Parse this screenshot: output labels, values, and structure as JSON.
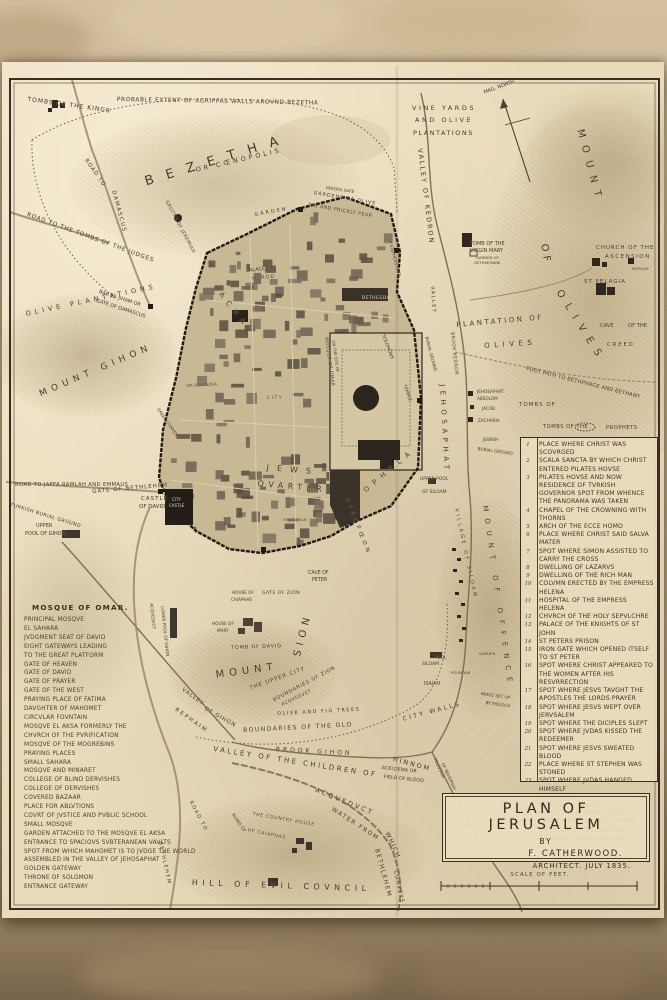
{
  "colors": {
    "paper": "#e8daba",
    "ink": "#3d3428",
    "wall_dark": "#201b15",
    "hill": "#a8946d",
    "backdrop": "#c9b492"
  },
  "sheet": {
    "title_block": {
      "line1": "PLAN OF JERUSALEM",
      "line2": "BY",
      "line3": "F. CATHERWOOD.",
      "line4": "ARCHITECT. JULY 1835."
    },
    "scale": {
      "label": "SCALE OF FEET."
    },
    "mosque_list": {
      "title": "MOSQUE OF OMAR.",
      "lines": [
        "PRINCIPAL MOSQVE",
        "EL SAHARA",
        "JVDGMENT SEAT OF DAVID",
        "EIGHT GATEWAYS LEADING",
        "TO THE GREAT PLATFORM",
        "GATE OF HEAVEN",
        "GATE OF DAVID",
        "GATE OF PRAYER",
        "GATE OF THE WEST",
        "PRAYING PLACE OF FATIMA",
        "DAVGHTER OF MAHOMET",
        "CIRCVLAR FOVNTAIN",
        "MOSQVE EL AKSA FORMERLY THE",
        "CHVRCH OF THE PVRIFICATION",
        "MOSQVE OF THE MOGREBINS",
        "PRAYING PLACES",
        "SMALL SAHARA",
        "MOSQVE AND MINARET",
        "COLLEGE OF BLIND DERVISHES",
        "COLLEGE OF DERVISHES",
        "COVERED BAZAAR",
        "PLACE FOR ABLVTIONS",
        "COVRT OF JVSTICE AND PVBLIC SCHOOL",
        "SMALL MOSQVE",
        "GARDEN ATTACHED TO THE MOSQVE EL AKSA",
        "ENTRANCE TO SPACIOVS SVBTERANEAN VAVLTS",
        "SPOT FROM WHICH MAHOMET IS TO JVDGE THE WORLD",
        "ASSEMBLED IN THE VALLEY OF JEHOSAPHAT",
        "GOLDEN GATEWAY",
        "THRONE OF SOLOMON",
        "ENTRANCE GATEWAY"
      ]
    },
    "reference_list": {
      "items": [
        {
          "n": "1",
          "t": "PLACE WHERE CHRIST WAS SCOVRGED"
        },
        {
          "n": "2",
          "t": "SCALA SANCTA BY WHICH CHRIST ENTERED PILATES HOVSE"
        },
        {
          "n": "3",
          "t": "PILATES HOVSE AND NOW RESIDENCE OF TVRKISH GOVERNOR  SPOT FROM WHENCE THE PANORAMA WAS TAKEN"
        },
        {
          "n": "4",
          "t": "CHAPEL OF THE CROWNING WITH THORNS"
        },
        {
          "n": "5",
          "t": "ARCH OF THE ECCE HOMO"
        },
        {
          "n": "6",
          "t": "PLACE WHERE CHRIST SAID SALVA MATER"
        },
        {
          "n": "7",
          "t": "SPOT WHERE SIMON ASSISTED TO CARRY THE CROSS"
        },
        {
          "n": "8",
          "t": "DWELLING OF LAZARVS"
        },
        {
          "n": "9",
          "t": "DWELLING OF THE RICH MAN"
        },
        {
          "n": "10",
          "t": "COLVMN ERECTED BY THE EMPRESS HELENA"
        },
        {
          "n": "11",
          "t": "HOSPITAL OF THE EMPRESS HELENA"
        },
        {
          "n": "12",
          "t": "CHVRCH OF THE HOLY SEPVLCHRE"
        },
        {
          "n": "13",
          "t": "PALACE OF THE KNIGHTS OF ST JOHN"
        },
        {
          "n": "14",
          "t": "ST PETERS PRISON"
        },
        {
          "n": "15",
          "t": "IRON GATE WHICH OPENED ITSELF TO ST PETER"
        },
        {
          "n": "16",
          "t": "SPOT WHERE CHRIST APPEARED TO THE WOMEN AFTER HIS RESVRRECTION"
        },
        {
          "n": "17",
          "t": "SPOT WHERE JESVS TAVGHT THE APOSTLES THE LORDS PRAYER"
        },
        {
          "n": "18",
          "t": "SPOT WHERE JESVS WEPT OVER JERVSALEM"
        },
        {
          "n": "19",
          "t": "SPOT WHERE THE DICIPLES SLEPT"
        },
        {
          "n": "20",
          "t": "SPOT WHERE JVDAS KISSED THE REDEEMER"
        },
        {
          "n": "21",
          "t": "SPOT WHERE JESVS SWEATED BLOOD"
        },
        {
          "n": "22",
          "t": "PLACE WHERE ST STEPHEN WAS STONED"
        },
        {
          "n": "23",
          "t": "SPOT WHERE JVDAS HANGED HIMSELF"
        },
        {
          "n": "24",
          "t": "SPOT WHERE THE PROPHET ISAIAH WAS SAWN ASVNDER"
        },
        {
          "n": "25",
          "t": "CŒNACVLVM WHERE CHRIST INSTITVTED THE LAST SVPPER"
        },
        {
          "n": "26",
          "t": "CATHOLIC BVRIAL GROVND"
        },
        {
          "n": "27",
          "t": "ARMENIAN BVRIAL GROVND"
        }
      ]
    },
    "labels": [
      {
        "t": "TOMBS OF THE KINGS",
        "x": 28,
        "y": 96,
        "r": 8,
        "s": 6,
        "p": 1
      },
      {
        "t": "PROBABLE EXTENT OF AGRIPPAS WALLS AROVND BEZETHA",
        "x": 117,
        "y": 97,
        "r": 1,
        "s": 5.8,
        "p": 0.6
      },
      {
        "t": "VINE YARDS",
        "x": 412,
        "y": 104,
        "s": 6.5,
        "p": 2.5
      },
      {
        "t": "AND OLIVE",
        "x": 415,
        "y": 116,
        "s": 6.5,
        "p": 2.5
      },
      {
        "t": "PLANTATIONS",
        "x": 413,
        "y": 129,
        "s": 6.5,
        "p": 1.5
      },
      {
        "t": "MAG. NORTH",
        "x": 483,
        "y": 90,
        "r": -20,
        "s": 5
      },
      {
        "t": "BEZETHA",
        "x": 143,
        "y": 175,
        "r": -17,
        "s": 13,
        "p": 13
      },
      {
        "t": "OR CŒNOPOLIS",
        "x": 195,
        "y": 166,
        "r": -13,
        "s": 6.5,
        "p": 3
      },
      {
        "t": "ROAD TO",
        "x": 88,
        "y": 158,
        "r": 55,
        "s": 5.5,
        "p": 1
      },
      {
        "t": "DAMASCUS",
        "x": 116,
        "y": 190,
        "r": 75,
        "s": 5.5,
        "p": 1.5
      },
      {
        "t": "GROTTO OF JEREMIAH",
        "x": 168,
        "y": 200,
        "r": 62,
        "s": 4.5,
        "p": 0.5
      },
      {
        "t": "ROAD TO THE TOMBS OF THE JUDGES",
        "x": 28,
        "y": 212,
        "r": 20,
        "s": 5.8,
        "p": 0.8
      },
      {
        "t": "OLIVE PLANTATIONS",
        "x": 25,
        "y": 310,
        "r": -12,
        "s": 6.5,
        "p": 4
      },
      {
        "t": "BAB ES SHAM OR",
        "x": 100,
        "y": 289,
        "r": 18,
        "s": 5
      },
      {
        "t": "GATE OF DAMASCUS",
        "x": 97,
        "y": 298,
        "r": 18,
        "s": 5
      },
      {
        "t": "MOUNT GIHON",
        "x": 38,
        "y": 390,
        "r": -23,
        "s": 9,
        "p": 5
      },
      {
        "t": "VALLEY OF KEDRON",
        "x": 424,
        "y": 148,
        "r": 83,
        "s": 6.5,
        "p": 2
      },
      {
        "t": "MOUNT",
        "x": 585,
        "y": 128,
        "r": 75,
        "s": 10,
        "p": 8
      },
      {
        "t": "OF",
        "x": 549,
        "y": 243,
        "r": 80,
        "s": 10,
        "p": 4
      },
      {
        "t": "OLIVES",
        "x": 563,
        "y": 288,
        "r": 58,
        "s": 10,
        "p": 8
      },
      {
        "t": "TOMB OF THE",
        "x": 470,
        "y": 241,
        "s": 5
      },
      {
        "t": "VIRGIN MARY",
        "x": 470,
        "y": 248,
        "s": 5
      },
      {
        "t": "GARDEN OF",
        "x": 476,
        "y": 255,
        "s": 3.8
      },
      {
        "t": "GETHSEMANE",
        "x": 474,
        "y": 260,
        "s": 3.8
      },
      {
        "t": "CHURCH OF THE",
        "x": 596,
        "y": 245,
        "s": 5.5,
        "p": 1
      },
      {
        "t": "ASCENSION",
        "x": 605,
        "y": 254,
        "s": 5.5,
        "p": 1.5
      },
      {
        "t": "MOSQUE",
        "x": 632,
        "y": 266,
        "s": 3.8
      },
      {
        "t": "ST PELAGIA",
        "x": 584,
        "y": 279,
        "s": 5.5,
        "p": 1
      },
      {
        "t": "PLANTATION OF",
        "x": 456,
        "y": 321,
        "r": -5,
        "s": 7,
        "p": 2.5
      },
      {
        "t": "OLIVES",
        "x": 484,
        "y": 342,
        "r": -4,
        "s": 7,
        "p": 4.5
      },
      {
        "t": "CAVE",
        "x": 600,
        "y": 323,
        "s": 5.2
      },
      {
        "t": "OF THE",
        "x": 628,
        "y": 323,
        "s": 5.2
      },
      {
        "t": "CREED",
        "x": 607,
        "y": 342,
        "s": 5.2,
        "p": 2
      },
      {
        "t": "FOOT PATH TO BETHPHAGE AND BETHANY",
        "x": 527,
        "y": 366,
        "r": 14,
        "s": 5.2,
        "p": 0.2
      },
      {
        "t": "VALLEY",
        "x": 435,
        "y": 286,
        "r": 86,
        "s": 5,
        "p": 1.5
      },
      {
        "t": "BROOK KEDRON",
        "x": 454,
        "y": 332,
        "r": 84,
        "s": 4.5,
        "p": 0.5
      },
      {
        "t": "JEHOSAPHAT",
        "x": 446,
        "y": 384,
        "r": 87,
        "s": 7,
        "p": 4.5
      },
      {
        "t": "JEHOSAPHAT",
        "x": 477,
        "y": 389,
        "s": 4.2
      },
      {
        "t": "ABSOLOM",
        "x": 477,
        "y": 396,
        "s": 4.2
      },
      {
        "t": "JACOB",
        "x": 482,
        "y": 406,
        "s": 4.2
      },
      {
        "t": "ZACHARIA",
        "x": 478,
        "y": 418,
        "s": 4.2
      },
      {
        "t": "TOMBS OF",
        "x": 519,
        "y": 402,
        "s": 5.5,
        "p": 1
      },
      {
        "t": "TOMBS OF THE",
        "x": 543,
        "y": 424,
        "s": 5.2,
        "p": 0.5
      },
      {
        "t": "PROPHETS",
        "x": 606,
        "y": 425,
        "s": 5.2,
        "p": 0.5
      },
      {
        "t": "JEWISH",
        "x": 483,
        "y": 437,
        "s": 4.2
      },
      {
        "t": "BURIAL GROUND",
        "x": 478,
        "y": 446,
        "r": 8,
        "s": 4.2
      },
      {
        "t": "HERODS GATE",
        "x": 326,
        "y": 185,
        "r": 8,
        "s": 4
      },
      {
        "t": "GARDEN",
        "x": 254,
        "y": 212,
        "r": -10,
        "s": 5,
        "p": 2
      },
      {
        "t": "GARDENS OF OLIVE",
        "x": 314,
        "y": 191,
        "r": 10,
        "s": 4.8,
        "p": 1
      },
      {
        "t": "FIG AND PRICKLY PEAR",
        "x": 309,
        "y": 203,
        "r": 10,
        "s": 4.8,
        "p": 0.5
      },
      {
        "t": "PALACE OF",
        "x": 246,
        "y": 268,
        "r": -6,
        "s": 5
      },
      {
        "t": "HEROD",
        "x": 252,
        "y": 276,
        "r": -6,
        "s": 5,
        "p": 1
      },
      {
        "t": "ST STEPHENS GATE",
        "x": 392,
        "y": 238,
        "r": 75,
        "s": 4
      },
      {
        "t": "BETHESDA",
        "x": 362,
        "y": 296,
        "s": 4.5,
        "p": 0.5,
        "c": "light"
      },
      {
        "t": "ACRA",
        "x": 224,
        "y": 290,
        "r": 52,
        "s": 7.5,
        "p": 6
      },
      {
        "t": "CITY",
        "x": 267,
        "y": 396,
        "s": 4.5,
        "p": 1.5
      },
      {
        "t": "VIA DOLOROSA",
        "x": 186,
        "y": 383,
        "r": -3,
        "s": 4
      },
      {
        "t": "GREEK CONVENT",
        "x": 160,
        "y": 407,
        "r": 55,
        "s": 4.2
      },
      {
        "t": "JEWS",
        "x": 267,
        "y": 463,
        "r": 5,
        "s": 8,
        "p": 8
      },
      {
        "t": "QVARTER",
        "x": 258,
        "y": 479,
        "r": 5,
        "s": 8,
        "p": 4.5
      },
      {
        "t": "SYNAGOGUE",
        "x": 283,
        "y": 517,
        "s": 3.8
      },
      {
        "t": "MOSQUE OF OMAR",
        "x": 328,
        "y": 337,
        "r": 82,
        "s": 4.5,
        "p": 0.5
      },
      {
        "t": "ON THE SITE OF",
        "x": 336,
        "y": 340,
        "r": 82,
        "s": 4
      },
      {
        "t": "SOLOMONS",
        "x": 385,
        "y": 334,
        "r": 70,
        "s": 4.5
      },
      {
        "t": "TEMPLE",
        "x": 406,
        "y": 384,
        "r": 70,
        "s": 4.5
      },
      {
        "t": "BURIAL GROUND",
        "x": 429,
        "y": 336,
        "r": 75,
        "s": 4.2
      },
      {
        "t": "OPHELA",
        "x": 362,
        "y": 488,
        "r": -40,
        "s": 7,
        "p": 6
      },
      {
        "t": "TYROPŒON",
        "x": 349,
        "y": 498,
        "r": 68,
        "s": 5.5,
        "p": 3.5
      },
      {
        "t": "MOUNT OF OFFENCE",
        "x": 489,
        "y": 505,
        "r": 82,
        "s": 7,
        "p": 7
      },
      {
        "t": "VILLAGE OF SILOAM",
        "x": 459,
        "y": 508,
        "r": 78,
        "s": 5,
        "p": 2.5
      },
      {
        "t": "UPPER POOL",
        "x": 420,
        "y": 477,
        "s": 4.5
      },
      {
        "t": "OF SILOAM",
        "x": 422,
        "y": 490,
        "s": 4.5
      },
      {
        "t": "POOL",
        "x": 435,
        "y": 655,
        "s": 4.2
      },
      {
        "t": "SILOAM",
        "x": 422,
        "y": 662,
        "s": 4.5
      },
      {
        "t": "FOUNTAIN",
        "x": 451,
        "y": 670,
        "s": 3.8
      },
      {
        "t": "ISAIAH",
        "x": 424,
        "y": 682,
        "s": 4.8
      },
      {
        "t": "GARDEN",
        "x": 479,
        "y": 651,
        "s": 3.8
      },
      {
        "t": "IMAGE SET UP",
        "x": 481,
        "y": 691,
        "r": 8,
        "s": 4.2
      },
      {
        "t": "BY MOLOCH",
        "x": 486,
        "y": 700,
        "r": 8,
        "s": 4.2
      },
      {
        "t": "FOUNTAIN",
        "x": 437,
        "y": 757,
        "r": 65,
        "s": 4.2
      },
      {
        "t": "OF NEHEMIAH",
        "x": 445,
        "y": 762,
        "r": 65,
        "s": 4.2
      },
      {
        "t": "CAVE OF",
        "x": 308,
        "y": 571,
        "s": 4.8
      },
      {
        "t": "PETER",
        "x": 312,
        "y": 578,
        "s": 4.8
      },
      {
        "t": "GATE OF ZION",
        "x": 262,
        "y": 591,
        "s": 4.5,
        "p": 0.5
      },
      {
        "t": "HOUSE OF",
        "x": 232,
        "y": 590,
        "s": 4.2
      },
      {
        "t": "CAIAPHAS",
        "x": 231,
        "y": 597,
        "s": 4.2
      },
      {
        "t": "HOUSE OF",
        "x": 212,
        "y": 621,
        "s": 4.2
      },
      {
        "t": "MARY",
        "x": 217,
        "y": 628,
        "s": 4.2
      },
      {
        "t": "TOMB OF DAVID",
        "x": 231,
        "y": 645,
        "r": -2,
        "s": 5,
        "p": 0.8
      },
      {
        "t": "MOUNT",
        "x": 215,
        "y": 670,
        "r": -8,
        "s": 10,
        "p": 5
      },
      {
        "t": "SION",
        "x": 292,
        "y": 655,
        "r": -75,
        "s": 10,
        "p": 5
      },
      {
        "t": "THE UPPER CITY",
        "x": 249,
        "y": 686,
        "r": -20,
        "s": 5.5,
        "p": 1
      },
      {
        "t": "BOUNDARIES OF ZION",
        "x": 272,
        "y": 698,
        "r": -28,
        "s": 5,
        "p": 0.8
      },
      {
        "t": "ACQVEDVCT",
        "x": 281,
        "y": 703,
        "r": -25,
        "s": 4.5,
        "p": 0.5
      },
      {
        "t": "OLIVE AND FIG TREES",
        "x": 277,
        "y": 711,
        "r": -3,
        "s": 5,
        "p": 1.5
      },
      {
        "t": "BOUNDARIES OF THE OLD",
        "x": 243,
        "y": 727,
        "r": -3,
        "s": 6,
        "p": 1.5
      },
      {
        "t": "CITY WALLS",
        "x": 402,
        "y": 716,
        "r": -15,
        "s": 6,
        "p": 2.5
      },
      {
        "t": "LOWER POOL OF GIHON",
        "x": 165,
        "y": 606,
        "r": 84,
        "s": 4.2
      },
      {
        "t": "ACQVEDVCT",
        "x": 154,
        "y": 603,
        "r": 84,
        "s": 4.2
      },
      {
        "t": "VALLEY",
        "x": 184,
        "y": 687,
        "r": 36,
        "s": 5.5,
        "p": 1
      },
      {
        "t": "OF GIHON",
        "x": 206,
        "y": 706,
        "r": 30,
        "s": 5.5,
        "p": 1
      },
      {
        "t": "REPHAIM",
        "x": 177,
        "y": 707,
        "r": 35,
        "s": 5.5,
        "p": 2
      },
      {
        "t": "BROOK GIHON",
        "x": 276,
        "y": 746,
        "r": 3,
        "s": 6,
        "p": 3
      },
      {
        "t": "VALLEY OF THE CHILDREN OF",
        "x": 214,
        "y": 745,
        "r": 9,
        "s": 7,
        "p": 2.5
      },
      {
        "t": "HINNOM",
        "x": 394,
        "y": 755,
        "r": 15,
        "s": 6.5,
        "p": 2
      },
      {
        "t": "ACELDEMA OR",
        "x": 382,
        "y": 766,
        "r": 6,
        "s": 4.8
      },
      {
        "t": "FIELD OF BLOOD",
        "x": 384,
        "y": 775,
        "r": 6,
        "s": 4.8
      },
      {
        "t": "ACQVEDVCT",
        "x": 317,
        "y": 786,
        "r": 22,
        "s": 6.5,
        "p": 2.5
      },
      {
        "t": "WATER FROM",
        "x": 334,
        "y": 806,
        "r": 33,
        "s": 6,
        "p": 1.5
      },
      {
        "t": "WHICH",
        "x": 390,
        "y": 831,
        "r": 65,
        "s": 6,
        "p": 1.5
      },
      {
        "t": "BETHLEHEM",
        "x": 380,
        "y": 848,
        "r": 75,
        "s": 6,
        "p": 1.5
      },
      {
        "t": "CONVEYS",
        "x": 398,
        "y": 870,
        "r": 78,
        "s": 5.5,
        "p": 1
      },
      {
        "t": "RUINS OF",
        "x": 234,
        "y": 813,
        "r": 55,
        "s": 4.5
      },
      {
        "t": "THE COUNTRY HOUSE",
        "x": 253,
        "y": 812,
        "r": 10,
        "s": 4.5,
        "p": 0.8
      },
      {
        "t": "OF CAIAPHAS",
        "x": 248,
        "y": 828,
        "r": 12,
        "s": 4.5,
        "p": 0.8
      },
      {
        "t": "HILL OF EVIL COVNCIL",
        "x": 192,
        "y": 878,
        "r": 2,
        "s": 8,
        "p": 4.5
      },
      {
        "t": "ROAD TO",
        "x": 193,
        "y": 800,
        "r": 62,
        "s": 5,
        "p": 1.5
      },
      {
        "t": "BETHLEHEM",
        "x": 163,
        "y": 841,
        "r": 78,
        "s": 5,
        "p": 1.5
      },
      {
        "t": "ROAD TO JAFFA RAMLAH AND EMMAUS",
        "x": 15,
        "y": 482,
        "s": 5.2,
        "p": 0.4
      },
      {
        "t": "GATE OF BETHLEHEM",
        "x": 92,
        "y": 489,
        "r": -5,
        "s": 5.5,
        "p": 1
      },
      {
        "t": "CASTLE",
        "x": 141,
        "y": 496,
        "s": 5.5,
        "p": 1
      },
      {
        "t": "OF DAVID",
        "x": 139,
        "y": 504,
        "s": 5.5
      },
      {
        "t": "CITY",
        "x": 172,
        "y": 497,
        "s": 4,
        "c": "light"
      },
      {
        "t": "CASTLE",
        "x": 169,
        "y": 503,
        "s": 4,
        "c": "light"
      },
      {
        "t": "TURKISH BURIAL GROUND",
        "x": 11,
        "y": 503,
        "r": 17,
        "s": 4.8,
        "p": 0.5
      },
      {
        "t": "UPPER",
        "x": 36,
        "y": 523,
        "s": 5
      },
      {
        "t": "POOL OF GIHON",
        "x": 25,
        "y": 531,
        "s": 5
      }
    ]
  }
}
